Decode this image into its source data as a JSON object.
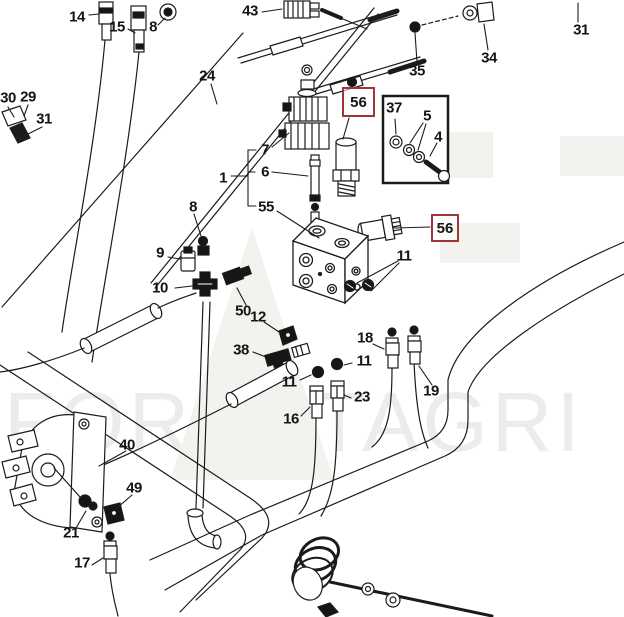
{
  "diagram": {
    "kind": "exploded-parts-diagram",
    "watermark": {
      "text": "FORESTAGRI",
      "color": "#ececec"
    },
    "highlight_color": "#9e3639",
    "line_color": "#1b1b1b",
    "callouts": [
      {
        "num": "14",
        "cx": 77,
        "cy": 17
      },
      {
        "num": "15",
        "cx": 117,
        "cy": 27
      },
      {
        "num": "8",
        "cx": 153,
        "cy": 27
      },
      {
        "num": "43",
        "cx": 250,
        "cy": 11
      },
      {
        "num": "31",
        "cx": 581,
        "cy": 30
      },
      {
        "num": "34",
        "cx": 489,
        "cy": 58
      },
      {
        "num": "35",
        "cx": 417,
        "cy": 71
      },
      {
        "num": "24",
        "cx": 207,
        "cy": 76
      },
      {
        "num": "30",
        "cx": 8,
        "cy": 98
      },
      {
        "num": "29",
        "cx": 28,
        "cy": 97
      },
      {
        "num": "31",
        "cx": 44,
        "cy": 119
      },
      {
        "num": "7",
        "cx": 265,
        "cy": 150
      },
      {
        "num": "6",
        "cx": 265,
        "cy": 172
      },
      {
        "num": "1",
        "cx": 223,
        "cy": 178
      },
      {
        "num": "55",
        "cx": 266,
        "cy": 207
      },
      {
        "num": "8",
        "cx": 193,
        "cy": 207
      },
      {
        "num": "37",
        "cx": 394,
        "cy": 108
      },
      {
        "num": "5",
        "cx": 427,
        "cy": 116
      },
      {
        "num": "4",
        "cx": 438,
        "cy": 137
      },
      {
        "num": "9",
        "cx": 160,
        "cy": 253
      },
      {
        "num": "10",
        "cx": 160,
        "cy": 288
      },
      {
        "num": "50",
        "cx": 243,
        "cy": 311
      },
      {
        "num": "12",
        "cx": 258,
        "cy": 317
      },
      {
        "num": "38",
        "cx": 241,
        "cy": 350
      },
      {
        "num": "11",
        "cx": 404,
        "cy": 256
      },
      {
        "num": "18",
        "cx": 365,
        "cy": 338
      },
      {
        "num": "11",
        "cx": 364,
        "cy": 361
      },
      {
        "num": "11",
        "cx": 289,
        "cy": 382
      },
      {
        "num": "23",
        "cx": 362,
        "cy": 397
      },
      {
        "num": "16",
        "cx": 291,
        "cy": 419
      },
      {
        "num": "19",
        "cx": 431,
        "cy": 391
      },
      {
        "num": "40",
        "cx": 127,
        "cy": 445
      },
      {
        "num": "49",
        "cx": 134,
        "cy": 488
      },
      {
        "num": "21",
        "cx": 71,
        "cy": 533
      },
      {
        "num": "17",
        "cx": 82,
        "cy": 563
      }
    ],
    "boxed_callouts": [
      {
        "num": "56",
        "x": 342,
        "y": 87,
        "w": 33,
        "h": 30
      },
      {
        "num": "56",
        "x": 431,
        "y": 214,
        "w": 28,
        "h": 28
      }
    ]
  }
}
